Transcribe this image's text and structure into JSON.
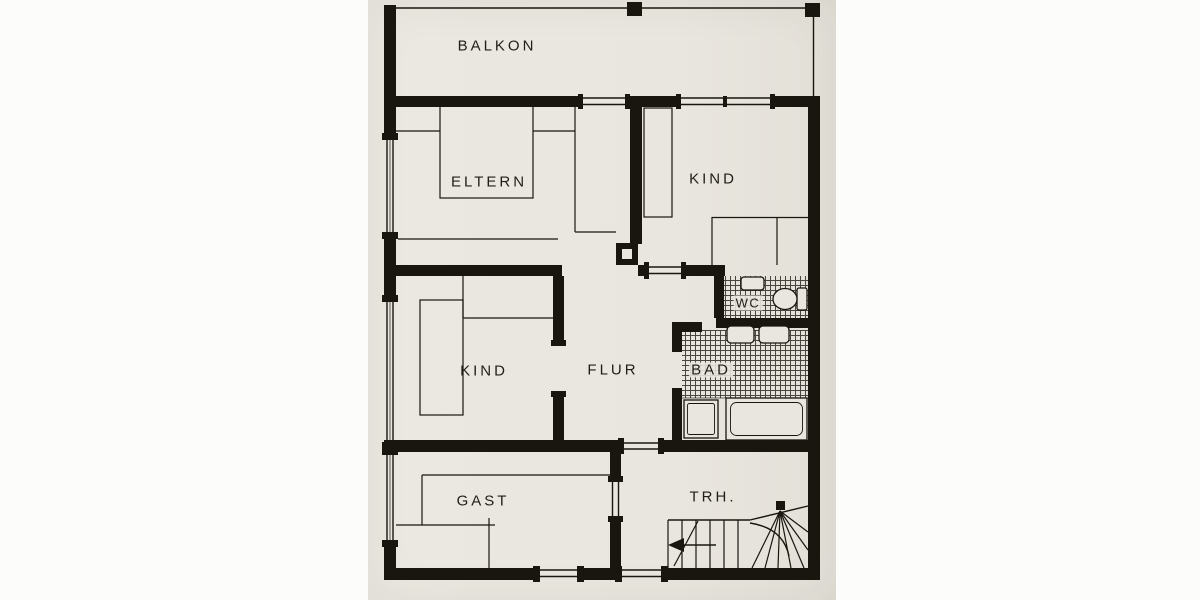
{
  "drawing": {
    "kind_label": "floor plan"
  },
  "rooms": [
    {
      "id": "balkon",
      "label": "BALKON"
    },
    {
      "id": "eltern",
      "label": "ELTERN"
    },
    {
      "id": "kind-nord",
      "label": "KIND"
    },
    {
      "id": "kind-west",
      "label": "KIND"
    },
    {
      "id": "flur",
      "label": "FLUR"
    },
    {
      "id": "wc",
      "label": "WC"
    },
    {
      "id": "bad",
      "label": "BAD"
    },
    {
      "id": "gast",
      "label": "GAST"
    },
    {
      "id": "treppenhaus",
      "label": "TRH."
    }
  ],
  "colors": {
    "paper": "#e9e6df",
    "ink": "#18160f",
    "page": "#fcfcfb"
  }
}
